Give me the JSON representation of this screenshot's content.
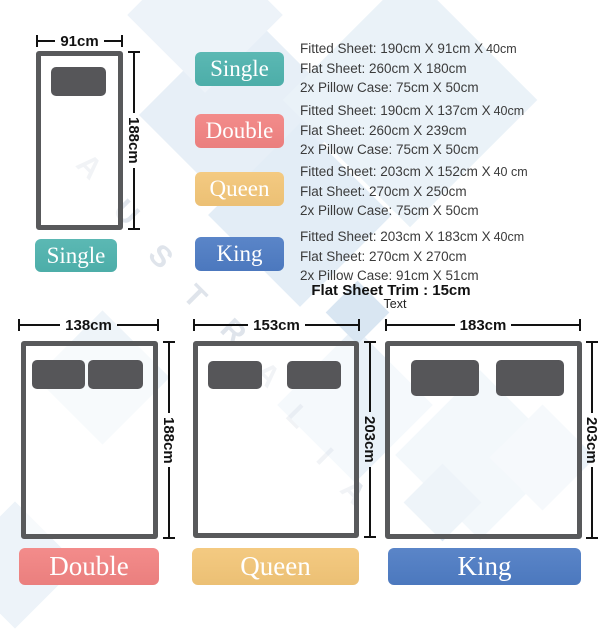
{
  "palette": {
    "single": "#4FB3AE",
    "double": "#F28382",
    "queen": "#F3C678",
    "king": "#4E7CC4",
    "frame_gray": "#58595B",
    "pillow_gray": "#565659",
    "dim_text": "#121212",
    "spec_text": "#3B3B3B",
    "watermark_blue": "#E3EDF6"
  },
  "top_diagram": {
    "name": "Single",
    "width": "91cm",
    "height": "188cm"
  },
  "specs": [
    {
      "size": "Single",
      "fitted": "Fitted Sheet: 190cm X 91cm X",
      "fitted_depth": "40cm",
      "flat": "Flat Sheet: 260cm X 180cm",
      "pillow": "2x Pillow Case: 75cm X 50cm"
    },
    {
      "size": "Double",
      "fitted": "Fitted Sheet: 190cm X 137cm X",
      "fitted_depth": "40cm",
      "flat": "Flat Sheet: 260cm X 239cm",
      "pillow": "2x Pillow Case: 75cm X 50cm"
    },
    {
      "size": "Queen",
      "fitted": "Fitted Sheet: 203cm X 152cm X",
      "fitted_depth": "40 cm",
      "flat": "Flat Sheet: 270cm X 250cm",
      "pillow": "2x Pillow Case: 75cm X 50cm"
    },
    {
      "size": "King",
      "fitted": "Fitted Sheet: 203cm X 183cm X",
      "fitted_depth": "40cm",
      "flat": "Flat Sheet: 270cm X 270cm",
      "pillow": "2x Pillow Case: 91cm X 51cm"
    }
  ],
  "trim_note": "Flat Sheet Trim : 15cm",
  "placeholder_note": "Text",
  "bottom_diagrams": [
    {
      "name": "Double",
      "width": "138cm",
      "height": "188cm"
    },
    {
      "name": "Queen",
      "width": "153cm",
      "height": "203cm"
    },
    {
      "name": "King",
      "width": "183cm",
      "height": "203cm"
    }
  ],
  "watermark": {
    "letters": [
      "A",
      "U",
      "S",
      "T",
      "R",
      "A",
      "L",
      "I",
      "A"
    ]
  }
}
